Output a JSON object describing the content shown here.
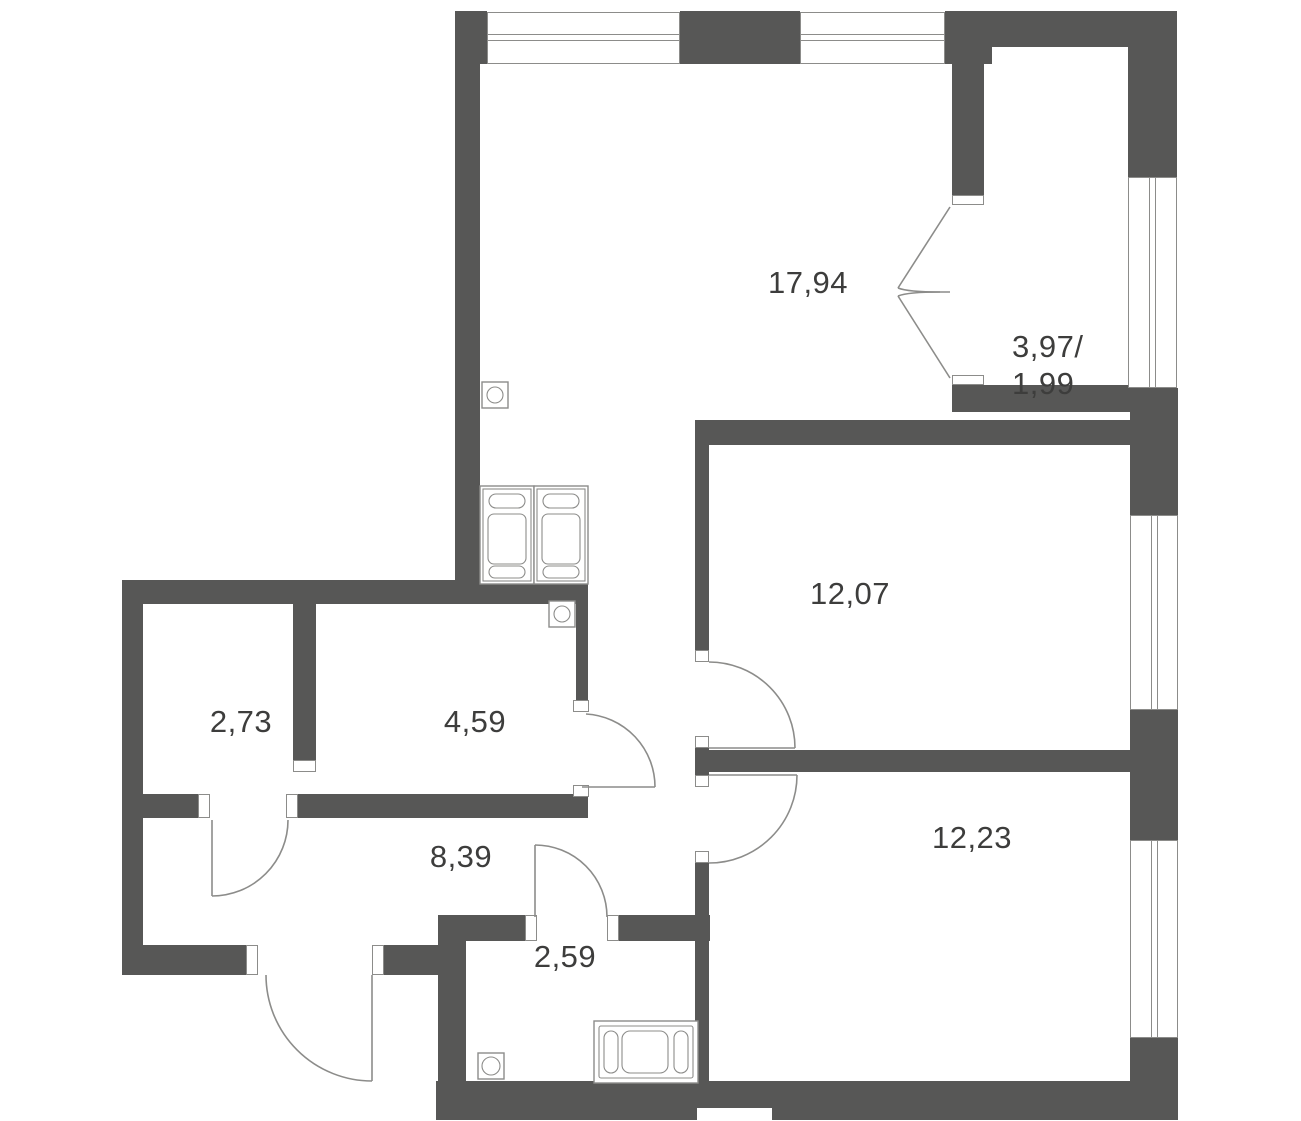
{
  "plan": {
    "rooms": [
      {
        "name": "living-room",
        "area": "17,94"
      },
      {
        "name": "balcony",
        "area_line1": "3,97/",
        "area_line2": "1,99"
      },
      {
        "name": "bedroom-1",
        "area": "12,07"
      },
      {
        "name": "kitchen-niche",
        "area": "4,59"
      },
      {
        "name": "storage",
        "area": "2,73"
      },
      {
        "name": "hallway",
        "area": "8,39"
      },
      {
        "name": "bathroom",
        "area": "2,59"
      },
      {
        "name": "bedroom-2",
        "area": "12,23"
      }
    ],
    "colors": {
      "wall": "#575756",
      "line": "#8c8c8a",
      "text": "#3d3d3c",
      "background": "#ffffff"
    }
  }
}
